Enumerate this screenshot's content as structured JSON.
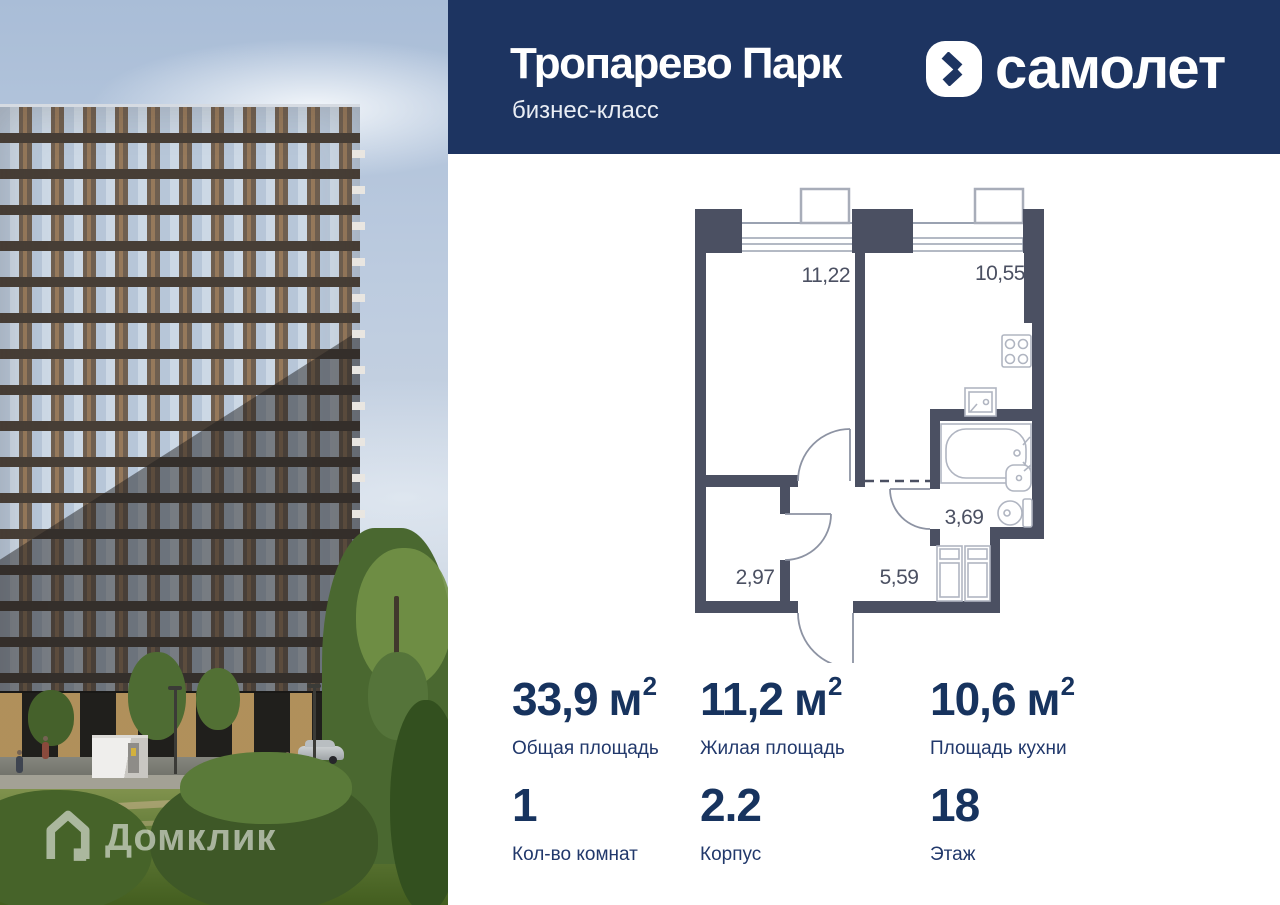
{
  "header": {
    "title": "Тропарево Парк",
    "subtitle": "бизнес-класс",
    "brand_name": "самолет",
    "brand_navy": "#1d3461"
  },
  "floorplan": {
    "wall_color": "#4b5062",
    "rooms": [
      {
        "name": "living-room",
        "area": "11,22"
      },
      {
        "name": "kitchen",
        "area": "10,55"
      },
      {
        "name": "wardrobe",
        "area": "2,97"
      },
      {
        "name": "hallway",
        "area": "5,59"
      },
      {
        "name": "bathroom",
        "area": "3,69"
      }
    ]
  },
  "stats": {
    "value_color": "#17335e",
    "items": [
      {
        "id": "total-area",
        "value": "33,9",
        "unit": "м",
        "unit_sup": "2",
        "label": "Общая площадь"
      },
      {
        "id": "living-area",
        "value": "11,2",
        "unit": "м",
        "unit_sup": "2",
        "label": "Жилая площадь"
      },
      {
        "id": "kitchen-area",
        "value": "10,6",
        "unit": "м",
        "unit_sup": "2",
        "label": "Площадь кухни"
      },
      {
        "id": "rooms-count",
        "value": "1",
        "label": "Кол-во комнат"
      },
      {
        "id": "building-number",
        "value": "2.2",
        "label": "Корпус"
      },
      {
        "id": "floor-number",
        "value": "18",
        "label": "Этаж"
      }
    ]
  },
  "watermark": {
    "text": "Домклик"
  }
}
